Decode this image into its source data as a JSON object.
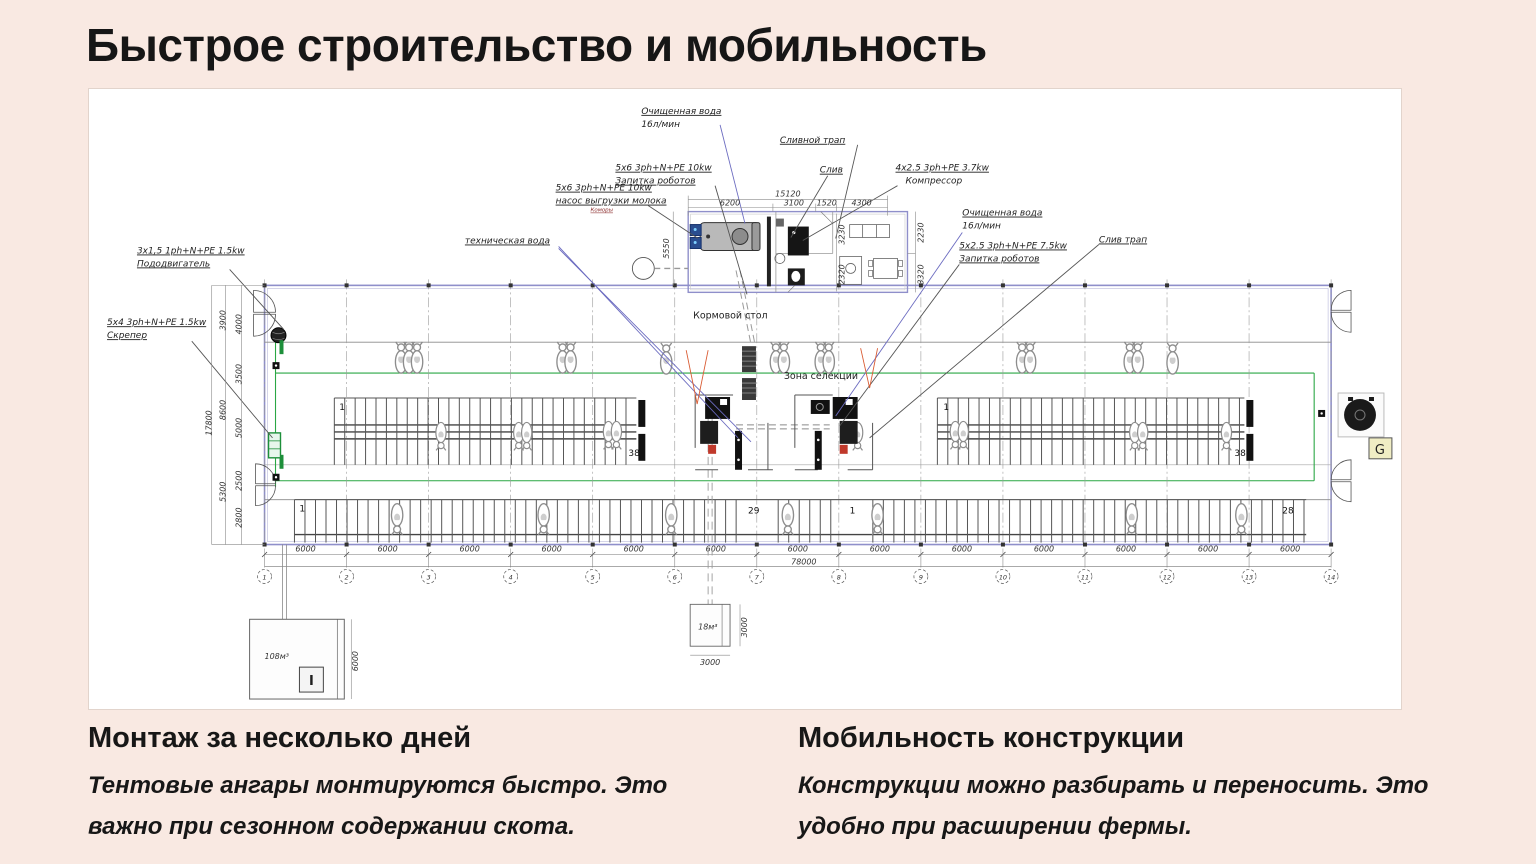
{
  "slide": {
    "title": "Быстрое строительство и мобильность",
    "features": [
      {
        "heading": "Монтаж за несколько дней",
        "body": "Тентовые ангары монтируются быстро. Это важно при сезонном содержании скота."
      },
      {
        "heading": "Мобильность конструкции",
        "body": "Конструкции можно разбирать и переносить. Это удобно при расширении фермы."
      }
    ]
  },
  "drawing": {
    "annotations": {
      "clean_water_left_1": "Очищенная вода",
      "clean_water_left_2": "16л/мин",
      "drain_trap": "Сливной трап",
      "robot_power_left_1": "5x6 3ph+N+PE 10kw",
      "robot_power_left_2": "Запитка роботов",
      "milk_pump_1": "5x6 3ph+N+PE 10kw",
      "milk_pump_2": "насос выгрузки молока",
      "milk_pump_3": "Коморы",
      "drain": "Слив",
      "compressor_1": "4x2.5 3ph+PE 3.7kw",
      "compressor_2": "Компрессор",
      "clean_water_right_1": "Очищенная вода",
      "clean_water_right_2": "16л/мин",
      "robot_power_right_1": "5x2.5 3ph+N+PE 7.5kw",
      "robot_power_right_2": "Запитка роботов",
      "drain_trap_right": "Слив трап",
      "tech_water": "техническая вода",
      "pusher_1": "3x1,5 1ph+N+PE 1.5kw",
      "pusher_2": "Пододвигатель",
      "scraper_1": "5x4 3ph+N+PE 1.5kw",
      "scraper_2": "Скрепер"
    },
    "areas": {
      "feed_table": "Кормовой стол",
      "selection_zone": "Зона селекции"
    },
    "counts": {
      "ul_start": "1",
      "ul_end": "38",
      "ur_start": "1",
      "ur_end": "38",
      "b_start": "1",
      "b_mid": "29",
      "b_mid2": "1",
      "b_end": "28"
    },
    "tanks": {
      "big": "108м³",
      "big_mark": "I",
      "small": "18м³"
    },
    "generator": "G",
    "grid": {
      "numbers": [
        "1",
        "2",
        "3",
        "4",
        "5",
        "6",
        "7",
        "8",
        "9",
        "10",
        "11",
        "12",
        "13",
        "14"
      ],
      "bay": "6000",
      "total": "78000"
    },
    "dims": {
      "left_total": "17800",
      "left_a": [
        "3900",
        "8600",
        "5300"
      ],
      "left_b": [
        "4000",
        "3500",
        "5000",
        "2500",
        "2800"
      ],
      "room_total": "15120",
      "room_top": [
        "6200",
        "3100",
        "1520",
        "4300"
      ],
      "room_left": "5550",
      "room_right": [
        "2230",
        "3320"
      ],
      "room_inner": [
        "3230",
        "2320"
      ],
      "small_tank": [
        "3000",
        "3000"
      ],
      "big_tank": "6000"
    }
  },
  "colors": {
    "background": "#f9e9e2",
    "panel": "#ffffff",
    "wall_blue": "#8f8fca",
    "water_blue": "#6b6bc0",
    "green": "#2aa44d",
    "orange": "#d95b33",
    "ink": "#1f1f1f"
  }
}
